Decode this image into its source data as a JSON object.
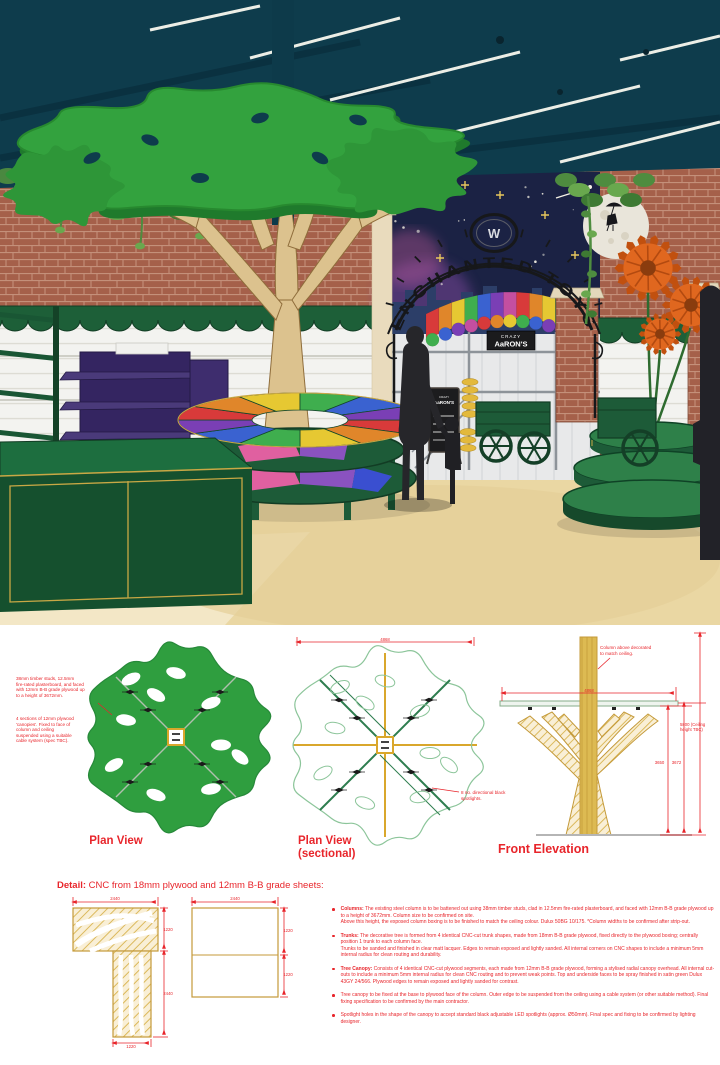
{
  "render": {
    "arch_sign": "ENCHANTED TOYS",
    "arch_monogram": "W",
    "awning_sign_top": "CRAZY",
    "awning_sign_main": "AaRON'S",
    "chalkboard_sign_top": "CRAZY",
    "chalkboard_sign_main": "AaRON'S",
    "awning_colors": [
      "#d83a3a",
      "#e0862a",
      "#e6c832",
      "#3fae4e",
      "#3a62d0",
      "#7a3fb5",
      "#c44fa0"
    ],
    "table_colors": [
      "#d83a3a",
      "#e0862a",
      "#e6c832",
      "#3fae4e",
      "#3a62d0",
      "#7a3fb5",
      "#d83a3a",
      "#e0862a",
      "#e6c832",
      "#3fae4e",
      "#3a62d0",
      "#7a3fb5"
    ],
    "colors": {
      "ceiling": "#0e3c4c",
      "brick": "#a5604a",
      "canopy_green": "#33a23e",
      "store_green": "#1d5b38",
      "purple": "#3a2b66",
      "gold_trim": "#c9a845",
      "floor": "#ead7a3",
      "mural_navy": "#1b2244",
      "flower_orange": "#e0671f",
      "drawing_red": "#e8252b",
      "drawing_gold": "#c9992f"
    }
  },
  "drawings": {
    "plan_view": {
      "label": "Plan View",
      "annotation_1": "38mm timber studs, 12.5mm\nfire-rated plasterboard, and faced\nwith 12mm B-B grade plywood up\nto a height of 3672mm.",
      "annotation_2": "4 sections of 12mm plywood\n'canopies'. Fixed to face of\ncolumn and ceiling\nsuspended using a suitable\ncable system (spec TBC)."
    },
    "plan_sectional": {
      "label_line1": "Plan View",
      "label_line2": "(sectional)",
      "width_dim": "4868",
      "annotation": "8 no. directional black\nspotlights."
    },
    "front_elevation": {
      "label": "Front Elevation",
      "annotation": "Column above decorated\nto match ceiling.",
      "canopy_width_dim": "4868",
      "ceiling_dim": "5800 (Ceiling\nheight TBC)",
      "dim_3650": "3650",
      "dim_3672": "3672"
    },
    "detail": {
      "heading_lead": "Detail:",
      "heading_rest": " CNC from 18mm plywood and 12mm B-B grade sheets:",
      "s1_top": "2440",
      "s1_right": "1220",
      "s1_right2": "2440",
      "s1_bottom": "1220",
      "s2_top": "2440",
      "s2_right": "1220",
      "s2_right2": "1220"
    },
    "notes": [
      {
        "lead": "Columns:",
        "text": " The existing steel column is to be battened out using 38mm timber studs, clad in 12.5mm fire-rated plasterboard, and faced with 12mm B-B grade plywood up to a height of 3672mm. Column size to be confirmed on site.\nAbove this height, the exposed column boxing is to be finished to match the ceiling colour. Dulux 50BG 10/175. *Column widths to be confirmed after strip-out."
      },
      {
        "lead": "Trunks:",
        "text": " The decorative tree is formed from 4 identical CNC-cut trunk shapes, made from 18mm B-B grade plywood, fixed directly to the plywood boxing; centrally position 1 trunk to each column face.\nTrunks to be sanded and finished in clear matt lacquer. Edges to remain exposed and lightly sanded. All internal corners on CNC shapes to include a minimum 5mm internal radius for clean routing and durability."
      },
      {
        "lead": "Tree Canopy:",
        "text": " Consists of 4 identical CNC-cut plywood segments, each made from 12mm B-B grade plywood, forming a stylised radial canopy overhead. All internal cut-outs to include a minimum 5mm internal radius for clean CNC routing and to prevent weak points. Top and underside faces to be spray finished in satin green Dulux 43GY 24/566. Plywood edges to remain exposed and lightly sanded for contrast."
      },
      {
        "lead": "",
        "text": "Tree canopy to be fixed at the base to plywood face of the column. Outer edge to be suspended from the ceiling using a cable system (or other suitable method). Final fixing specification to be confirmed by the main contractor."
      },
      {
        "lead": "",
        "text": "Spotlight holes in the shape of the canopy to accept standard black adjustable LED spotlights (approx. Ø50mm). Final spec and fixing to be confirmed by lighting designer."
      }
    ]
  }
}
